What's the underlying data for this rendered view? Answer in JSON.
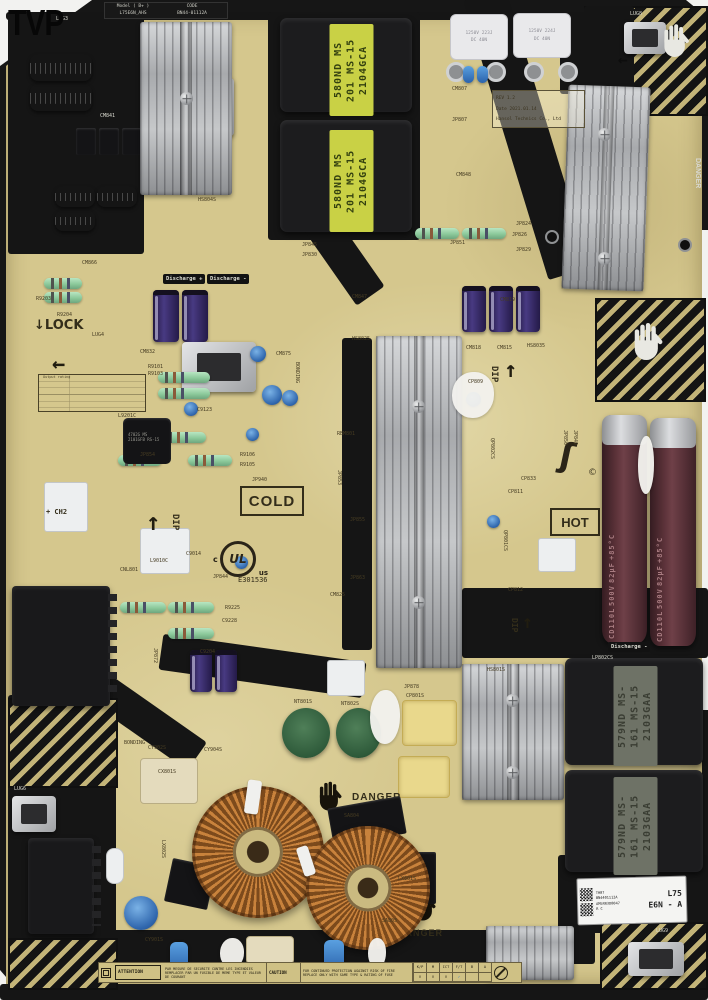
{
  "watermark": "TVP",
  "silkscreen": {
    "model_label": "Model ( B+ )",
    "model_value": "L75E6N_AHS",
    "code_label": "CODE",
    "code_value": "BN44-01112A",
    "rev": "REV 1.2",
    "date": "Date 2021.01.14",
    "maker": "Hansol Technics Co., Ltd",
    "cold": "COLD",
    "hot": "HOT",
    "lock": "LOCK",
    "bonding": "BONDING",
    "dip": "DIP",
    "danger": "DANGER",
    "discharge_plus": "Discharge +",
    "discharge_minus": "Discharge -",
    "ch2": "+ CH2",
    "output_rating": "Output rating",
    "ul": "UL",
    "ul_c": "c",
    "ul_us": "us",
    "ul_file": "E301536",
    "lug3": "LUG3",
    "lug4": "LUG4",
    "lug6": "LUG6",
    "lug8": "LUG8",
    "lug9": "LUG9"
  },
  "components": {
    "transformer_label_a": "580ND MS 201",
    "transformer_label_b": "MS-15 2104GCA",
    "transformer2_label_a": "579ND MS-161",
    "transformer2_label_b": "MS-15 2103GAA",
    "film_cap_1a": "1250V 223J",
    "film_cap_1b": "DC 40N",
    "film_cap_2a": "1250V 224J",
    "film_cap_2b": "DC 40N",
    "cap_l1": "CD110L",
    "cap_l2": "500V",
    "cap_l3": "82μF",
    "cap_l4": "+85°C",
    "l9201_label": "4702G MS 2101GFB RS-15"
  },
  "sticker": {
    "line1": "TH07",
    "line2": "BN4401112A",
    "line3": "AM5RR3D0047",
    "line4": "R C",
    "model": "L75",
    "version": "E6N - A"
  },
  "icons": {
    "arrow_left": "←",
    "arrow_up": "↑",
    "arrow_down": "↓",
    "check": "✓",
    "squiggle": "ʃ",
    "copyright": "©"
  },
  "designators": [
    "CNL801",
    "CM832",
    "CM841",
    "CM807",
    "CM848",
    "JP807",
    "JP824",
    "JP826",
    "JP851",
    "JP829",
    "JP845",
    "JP830",
    "HS8035",
    "CM819",
    "CM818",
    "CM815",
    "HS8025",
    "R9203",
    "R9204",
    "CM866",
    "HS804S",
    "R9101",
    "R9103",
    "C9123",
    "L9201C",
    "JP854",
    "R9106",
    "R9105",
    "JP940",
    "C9014",
    "JP844",
    "CM875",
    "CP809",
    "CM825",
    "JP863",
    "L9010C",
    "R9225",
    "C9228",
    "C9204",
    "JP872",
    "NT801S",
    "NT802S",
    "JP878",
    "CP801S",
    "HS801S",
    "SA804",
    "SA803",
    "LX801S",
    "LX802S",
    "CY902S",
    "CY904S",
    "CX801S",
    "CY901S",
    "QP802CS",
    "LP802CS",
    "RBM801",
    "CM847",
    "CP811",
    "CP812",
    "QP801CS",
    "JP853",
    "JP855",
    "CP833",
    "JP850",
    "JP849"
  ],
  "footer": {
    "attention_label": "ATTENTION",
    "attention_text": "PAR MESURE DE SECURITE CONTRE LES INCENDIES REMPLACER PAR UN FUSIBLE DE MEME TYPE ET VALEUR DE COURANT",
    "caution_label": "CAUTION",
    "caution_text": "FOR CONTINUED PROTECTION AGAINST RISK OF FIRE REPLACE ONLY WITH SAME TYPE & RATING OF FUSE",
    "table_headers": [
      "K/P",
      "M",
      "ICT",
      "F/T",
      "B",
      "A"
    ],
    "table_checks": [
      "V",
      "V",
      "V"
    ]
  },
  "colors": {
    "pcb": "#d5c78d",
    "black_zone": "#151515",
    "heatsink": "#b9bbbd",
    "transformer_label_green": "#c9d145",
    "cap_body": "#5d333a",
    "copper": "#b4702c",
    "blue_part": "#2a62ab"
  }
}
